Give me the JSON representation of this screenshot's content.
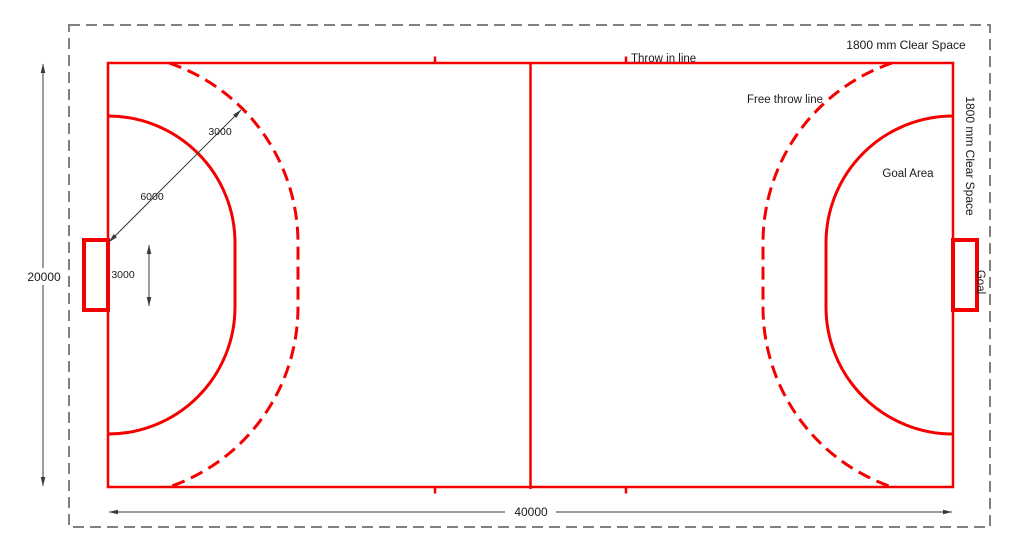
{
  "diagram": {
    "title": "Handball court plan",
    "labels": {
      "throw_in_line": "Throw in line",
      "free_throw_line": "Free throw line",
      "goal_area": "Goal Area",
      "goal": "Goal",
      "clear_space_top": "1800 mm Clear Space",
      "clear_space_right": "1800 mm Clear Space"
    },
    "dimensions": {
      "court_length_mm": "40000",
      "court_width_mm": "20000",
      "goal_width_mm": "3000",
      "goal_area_radius_mm": "6000",
      "free_throw_gap_mm": "3000"
    },
    "colors": {
      "court_line_red": "#f40000",
      "clear_space_border_gray": "#808080",
      "dimension_gray": "#3a3a3a",
      "text_dark": "#1a1a1a",
      "background": "#ffffff"
    }
  }
}
